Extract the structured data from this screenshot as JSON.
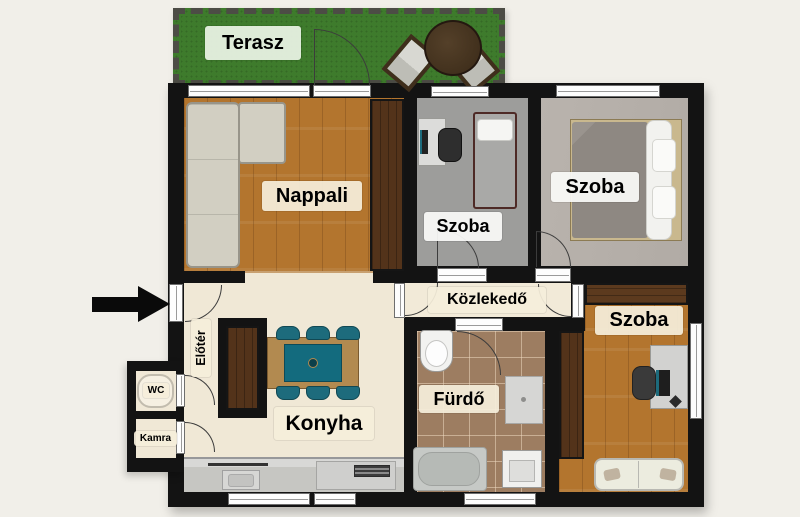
{
  "canvas": {
    "width": 800,
    "height": 517
  },
  "colors": {
    "background": "#f1efe9",
    "walls": "#131313",
    "terrace_green": "#3e7b2c",
    "wood_floor": "#b3752e",
    "dark_wood": "#53331a",
    "cream_floor": "#f0e8d6",
    "gray_carpet": "#9d9d9b",
    "light_carpet": "#b6b0aa",
    "bath_tile": "#9d7d61",
    "chair_teal": "#1d6b7c",
    "label_bg": "#f5eeda"
  },
  "rooms": {
    "terasz": {
      "label": "Terasz"
    },
    "nappali": {
      "label": "Nappali"
    },
    "szoba_kis": {
      "label": "Szoba"
    },
    "szoba_nagy": {
      "label": "Szoba"
    },
    "kozlekedo": {
      "label": "Közlekedő"
    },
    "eloter": {
      "label": "Előtér"
    },
    "wc": {
      "label": "WC"
    },
    "kamra": {
      "label": "Kamra"
    },
    "konyha": {
      "label": "Konyha"
    },
    "furdo": {
      "label": "Fürdő"
    },
    "szoba_also": {
      "label": "Szoba"
    }
  }
}
